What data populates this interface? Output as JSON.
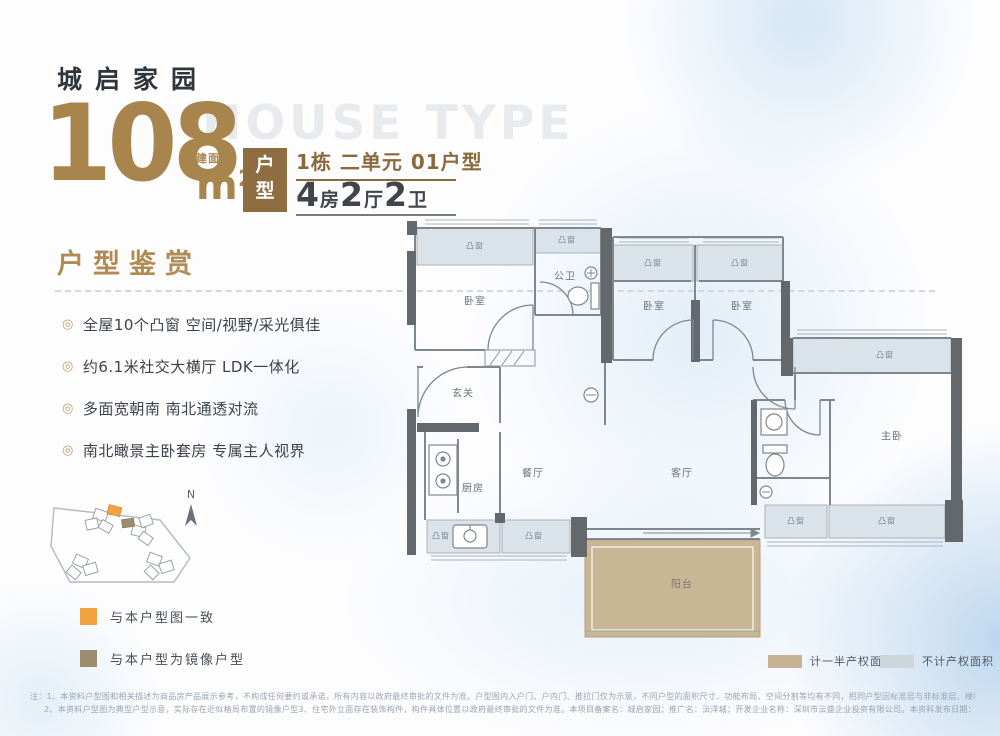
{
  "header": {
    "project_name": "城启家园",
    "area_value": "108",
    "area_prefix": "建面约",
    "area_unit": "m²",
    "watermark": "HOUSE TYPE",
    "type_badge_chars": [
      "户",
      "型"
    ],
    "unit_info": "1栋 二单元 01户型",
    "layout_parts": [
      "4",
      "房",
      "2",
      "厅",
      "2",
      "卫"
    ]
  },
  "features": {
    "title": "户型鉴赏",
    "bullet": "◎",
    "items": [
      "全屋10个凸窗 空间/视野/采光俱佳",
      "约6.1米社交大横厅 LDK一体化",
      "多面宽朝南 南北通透对流",
      "南北瞰景主卧套房 专属主人视界"
    ]
  },
  "sitemap": {
    "north_label": "N",
    "legend": [
      {
        "label": "与本户型图一致",
        "color": "#F2A342"
      },
      {
        "label": "与本户型为镜像户型",
        "color": "#9D8D70"
      }
    ]
  },
  "floorplan": {
    "bay_window_label": "凸窗",
    "rooms": {
      "bedroom1": "卧室",
      "bath_public": "公卫",
      "bedroom2": "卧室",
      "bedroom3": "卧室",
      "master_bedroom": "主卧",
      "entry": "玄关",
      "kitchen": "厨房",
      "dining": "餐厅",
      "living": "客厅",
      "balcony": "阳台"
    },
    "colors": {
      "wall": "#63686d",
      "bay_fill": "#dbe3ea",
      "balcony_fill": "#c9b695"
    },
    "legend": [
      {
        "label": "计一半产权面积",
        "color": "#C6B394"
      },
      {
        "label": "不计产权面积",
        "color": "#CDD6DB"
      }
    ]
  },
  "footnotes": {
    "line1": "注：1、本资料户型图和相关描述为商品房产品展示参考，不构成任何要约或承诺，所有内容以政府最终审批的文件为准。户型图内入户门、户内门、推拉门仅为示意，不同户型的面积尺寸、功能布局、空间分割等均有不同，相同户型因标准层与非标准层、楼栋、楼层、单元、朝向、等差异，局部外观、结构、管道、尺寸、面积等也可能不同。",
    "line2": "2、本资料户型图为典型户型示意，实际存在近似格局布置的镜像户型3、住宅外立面存在装饰构件，构件具体位置以政府最终审批的文件为准。本项目备案名：城启家园；推广名：沄洋城；开发企业名称：深圳市沄盛企业投资有限公司。本资料发布日期：2024年10月。"
  }
}
